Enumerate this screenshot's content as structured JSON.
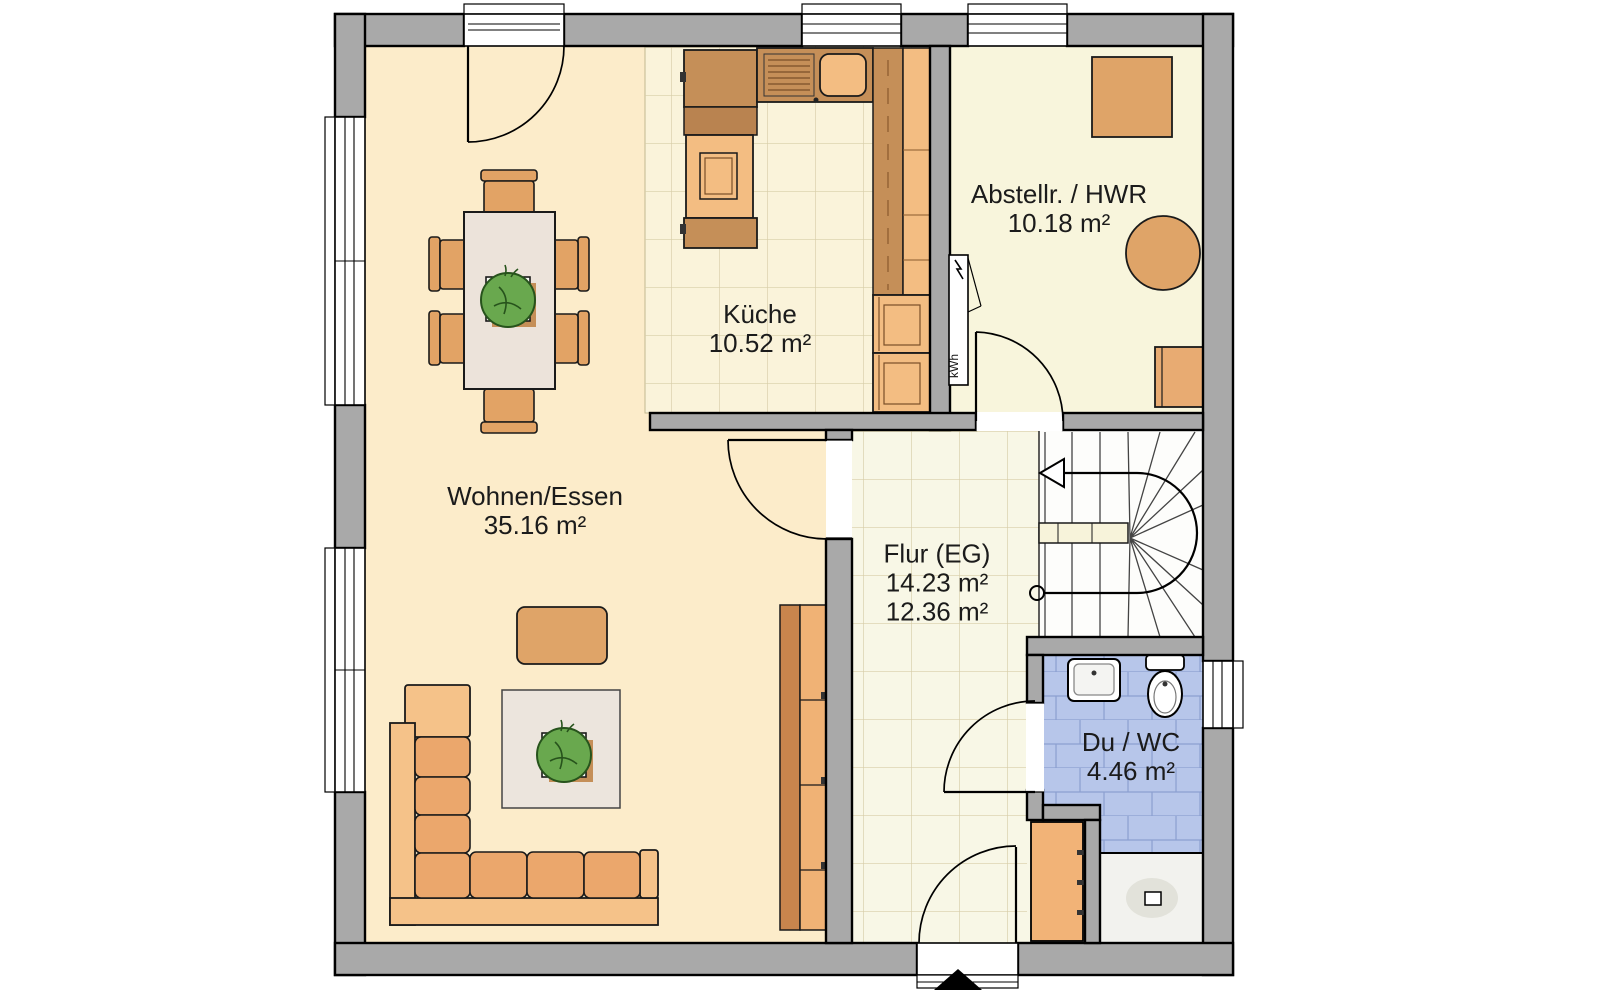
{
  "plan": {
    "title": "Erdgeschoss Grundriss",
    "rooms": [
      {
        "id": "wohnen",
        "label": "Wohnen/Essen",
        "area": "35.16 m²"
      },
      {
        "id": "kueche",
        "label": "Küche",
        "area": "10.52 m²"
      },
      {
        "id": "abstellraum",
        "label": "Abstellr. / HWR",
        "area": "10.18 m²"
      },
      {
        "id": "flur",
        "label": "Flur (EG)",
        "area": "14.23 m²",
        "area2": "12.36 m²"
      },
      {
        "id": "duwc",
        "label": "Du / WC",
        "area": "4.46 m²"
      }
    ],
    "meter_label": "kWh",
    "colors": {
      "wall": "#a9a9a9",
      "floor_living": "#fcecca",
      "floor_kitchen_tile": "#faf3da",
      "floor_hall_tile": "#f8f7e6",
      "floor_storage": "#f8f5dc",
      "bath_tile": "#b7c6ea",
      "bath_tile_line": "#8b9fd0",
      "furniture_mid": "#dfa468",
      "counter_dark": "#c58f58",
      "cabinet_light": "#f3bd82",
      "sofa_cushion": "#eba76c",
      "sofa_base": "#f5c289",
      "plant_green": "#69a84e"
    }
  }
}
